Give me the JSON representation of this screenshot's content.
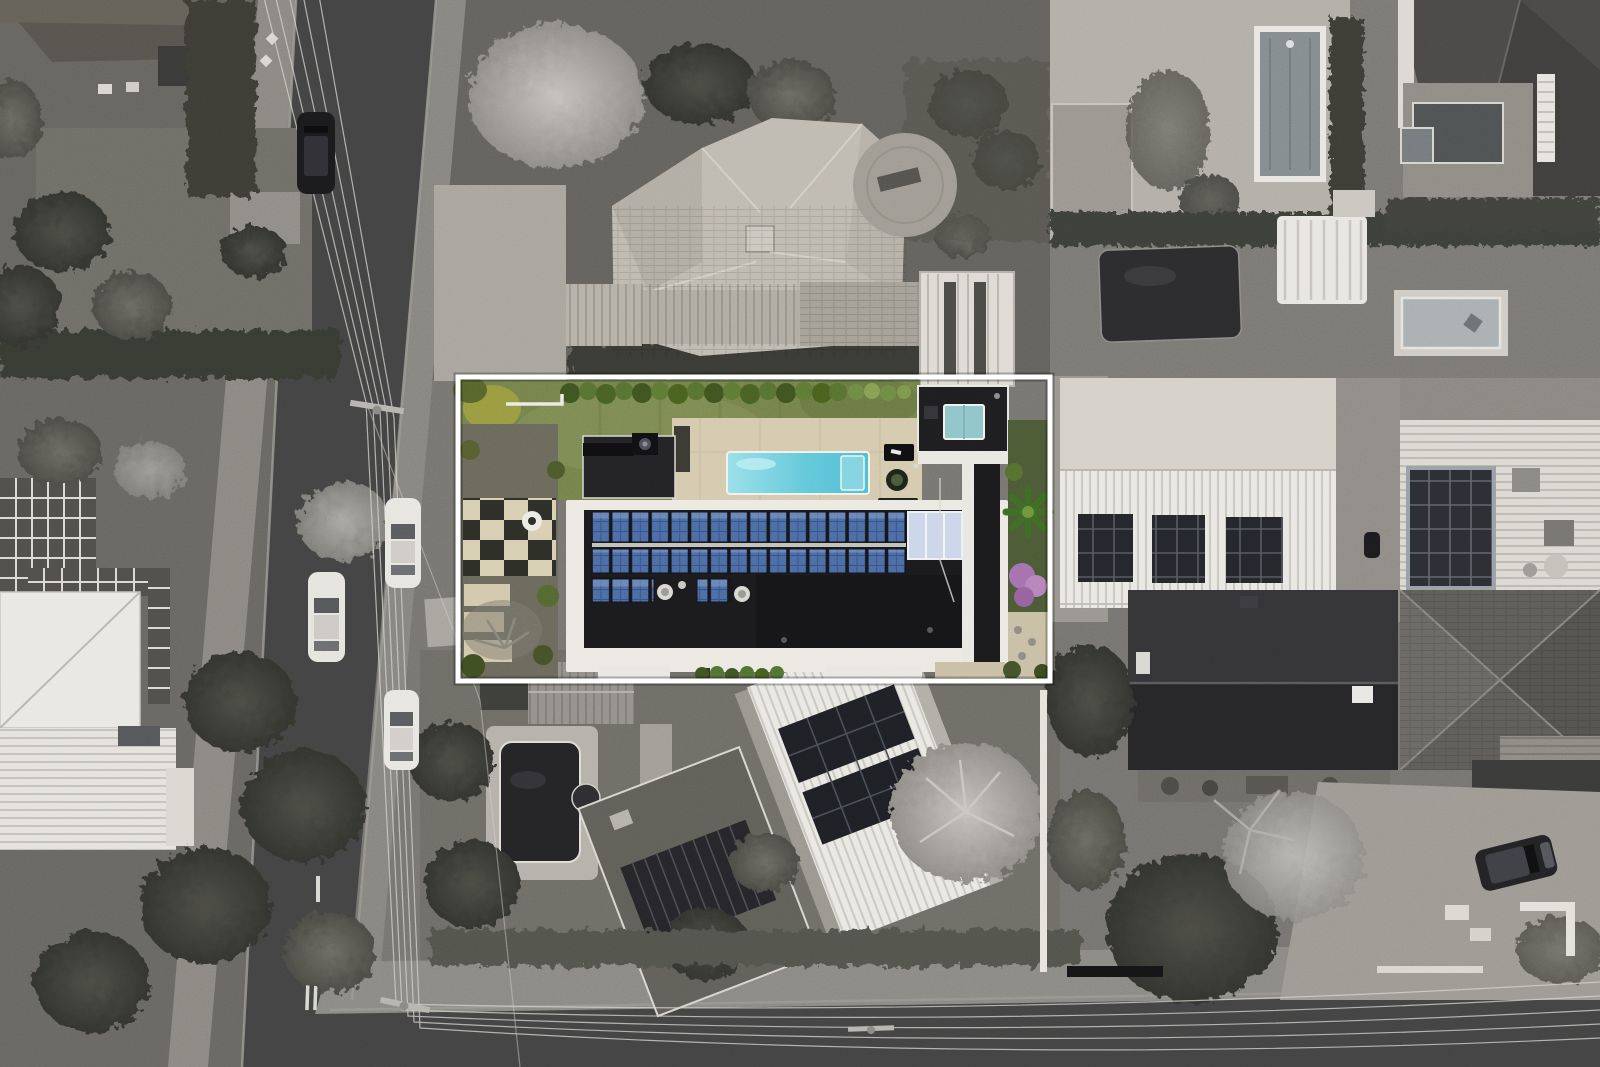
{
  "scene": {
    "kind": "aerial-drone-photograph",
    "style": "selective-colour real-estate hero shot: subject lot in colour, surroundings desaturated",
    "palette": {
      "backdrop": "#76756f",
      "road": "#434343",
      "roadEdge": "#9c9a93",
      "sidewalk": "#8e8c85",
      "paleConcrete": "#b2afa7",
      "roofWhite": "#eae8e2",
      "roofLightTile": "#bfbab1",
      "roofMid": "#8f8c85",
      "roofDark": "#2b2b2c",
      "roofCharcoal": "#1b1b1d",
      "treeDark": "#3f403a",
      "treeMid": "#5b5b54",
      "treeLight": "#b2b0a9",
      "hedgeGray": "#383933",
      "wire": "#d6d4ce",
      "boundary": "#ffffff",
      "lawn": "#75834b",
      "lawnLight": "#86935c",
      "hedgeGreen": "#3f5420",
      "hedgeGreen2": "#567231",
      "bushYellow": "#9a9b40",
      "pool": "#4fbdd5",
      "poolLight": "#98dfe9",
      "terrace": "#d5caae",
      "solarBlue": "#4b6ca3",
      "solarCell": "#35538a",
      "solarLight": "#7f9bc5",
      "solarPale": "#ccd6ea",
      "spaAqua": "#8fc5ca",
      "palmGreen": "#3f6b24",
      "blossomPurple": "#a571ad",
      "gardenGreen": "#4b5a35",
      "pathBeige": "#c9bfa6"
    },
    "subject_property": {
      "boundary_outline": "white rectangle",
      "features": [
        "lawn",
        "box-hedge-row",
        "swimming-pool",
        "pool-terrace",
        "flat-roof-residence",
        "rooftop-solar-arrays",
        "solar-hot-water-panels",
        "spa-skylight",
        "paver-courtyard",
        "palm-tree",
        "purple-flowering-tree"
      ]
    },
    "surroundings": {
      "streets": 2,
      "visible_vehicles": 5,
      "neighbour_pools": 4,
      "neighbour_solar_roofs": 3,
      "power_lines": "overhead wires along both streets with timber poles"
    }
  }
}
